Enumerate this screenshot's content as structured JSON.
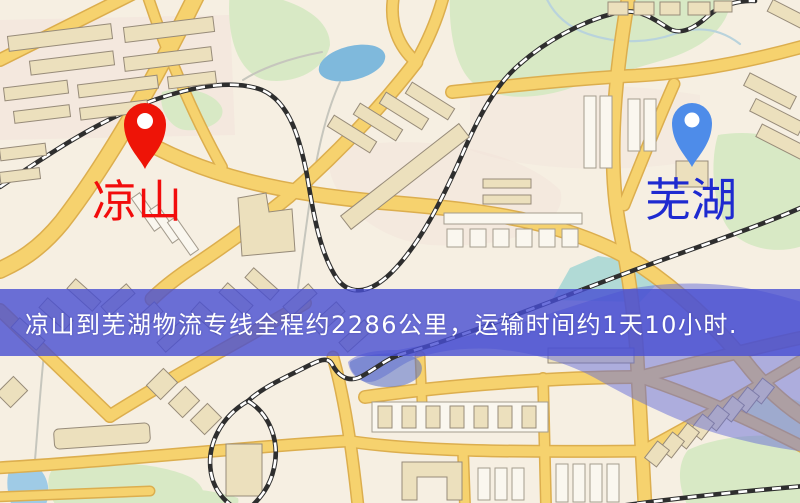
{
  "app": {
    "type": "map-route-view"
  },
  "markers": {
    "origin": {
      "name": "凉山",
      "pin_color": "#ee1407",
      "label_color": "#f20c0c"
    },
    "destination": {
      "name": "芜湖",
      "pin_color": "#4e8ce9",
      "label_color": "#1e2ad0"
    }
  },
  "banner": {
    "text": "凉山到芜湖物流专线全程约2286公里，运输时间约1天10小时.",
    "background_color": "rgba(71,78,210,0.8)",
    "text_color": "#ffffff"
  },
  "map_colors": {
    "background": "#f6efe2",
    "road_fill": "#f6d26e",
    "road_casing": "#dcae4e",
    "park_green": "#d8e9c5",
    "pond_blue": "#7fb9dc",
    "river_overlay_blue": "#636bd8",
    "railway_black": "#2e2e2e",
    "building_tan": "#ece0bd"
  }
}
